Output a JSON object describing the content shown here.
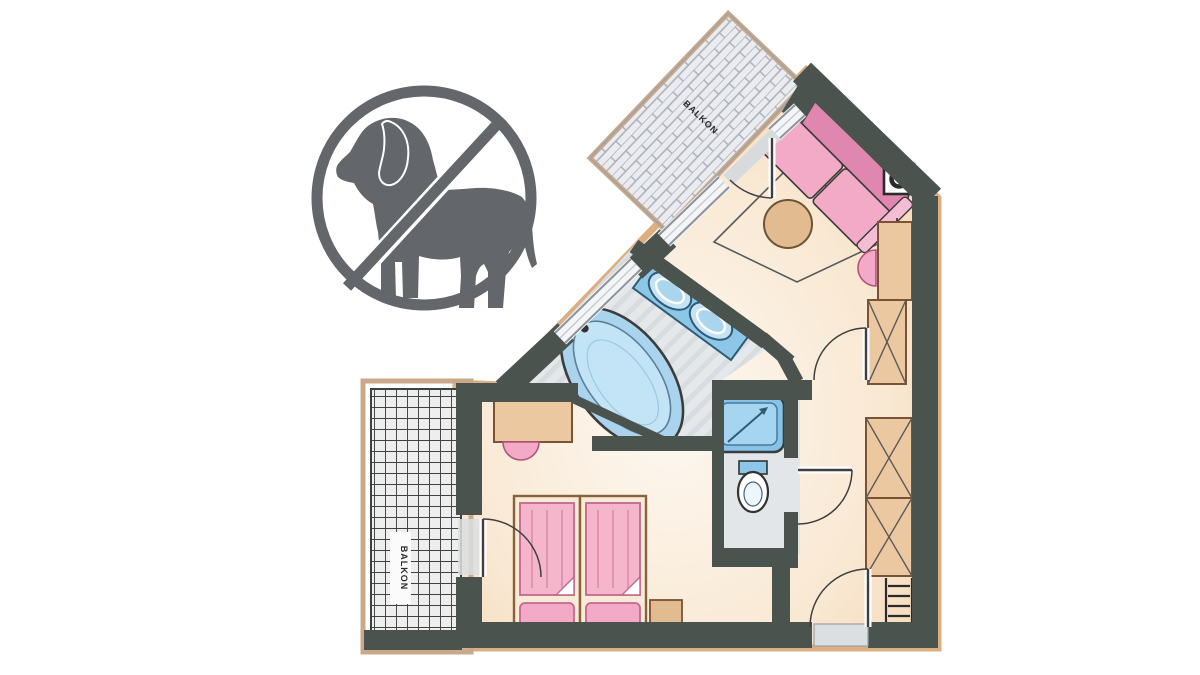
{
  "page": {
    "width": 1200,
    "height": 675,
    "background": "#ffffff",
    "description": "Hand-drawn hotel room floor plan with a no-dogs-allowed prohibition sign"
  },
  "no_dogs_sign": {
    "symbol": "dog-silhouette",
    "meaning": "no dogs allowed",
    "color": "#63666b",
    "shape": "circle-with-diagonal-slash"
  },
  "floor_plan": {
    "labels": {
      "top_balcony": "BALKON",
      "left_balcony": "BALKON"
    },
    "colors": {
      "walls": "#4b534e",
      "floor_peach": "#f6d9bc",
      "furniture_pink": "#f2aac6",
      "furniture_pink_dark": "#df87ae",
      "fixture_blue": "#8cc7e9",
      "fixture_blue_light": "#bfe2f5",
      "wood_tan": "#ecc8a0",
      "wood_outline": "#7a5236",
      "tile_gray": "#e4e8eb",
      "frame_tan": "#c9a98a"
    },
    "rooms": [
      "top-balcony",
      "living-area",
      "bathroom",
      "shower-room",
      "wc",
      "hallway",
      "bedroom",
      "left-balcony"
    ],
    "fixtures": [
      "sofa",
      "round-table",
      "area-rug",
      "stove",
      "ceiling-light-symbol",
      "dresser",
      "wardrobe",
      "side-chair",
      "double-sink-vanity",
      "bathtub",
      "shower",
      "toilet",
      "desk",
      "desk-chair",
      "twin-beds",
      "nightstand",
      "coat-hooks",
      "entry-threshold",
      "door-swings",
      "windows"
    ]
  }
}
